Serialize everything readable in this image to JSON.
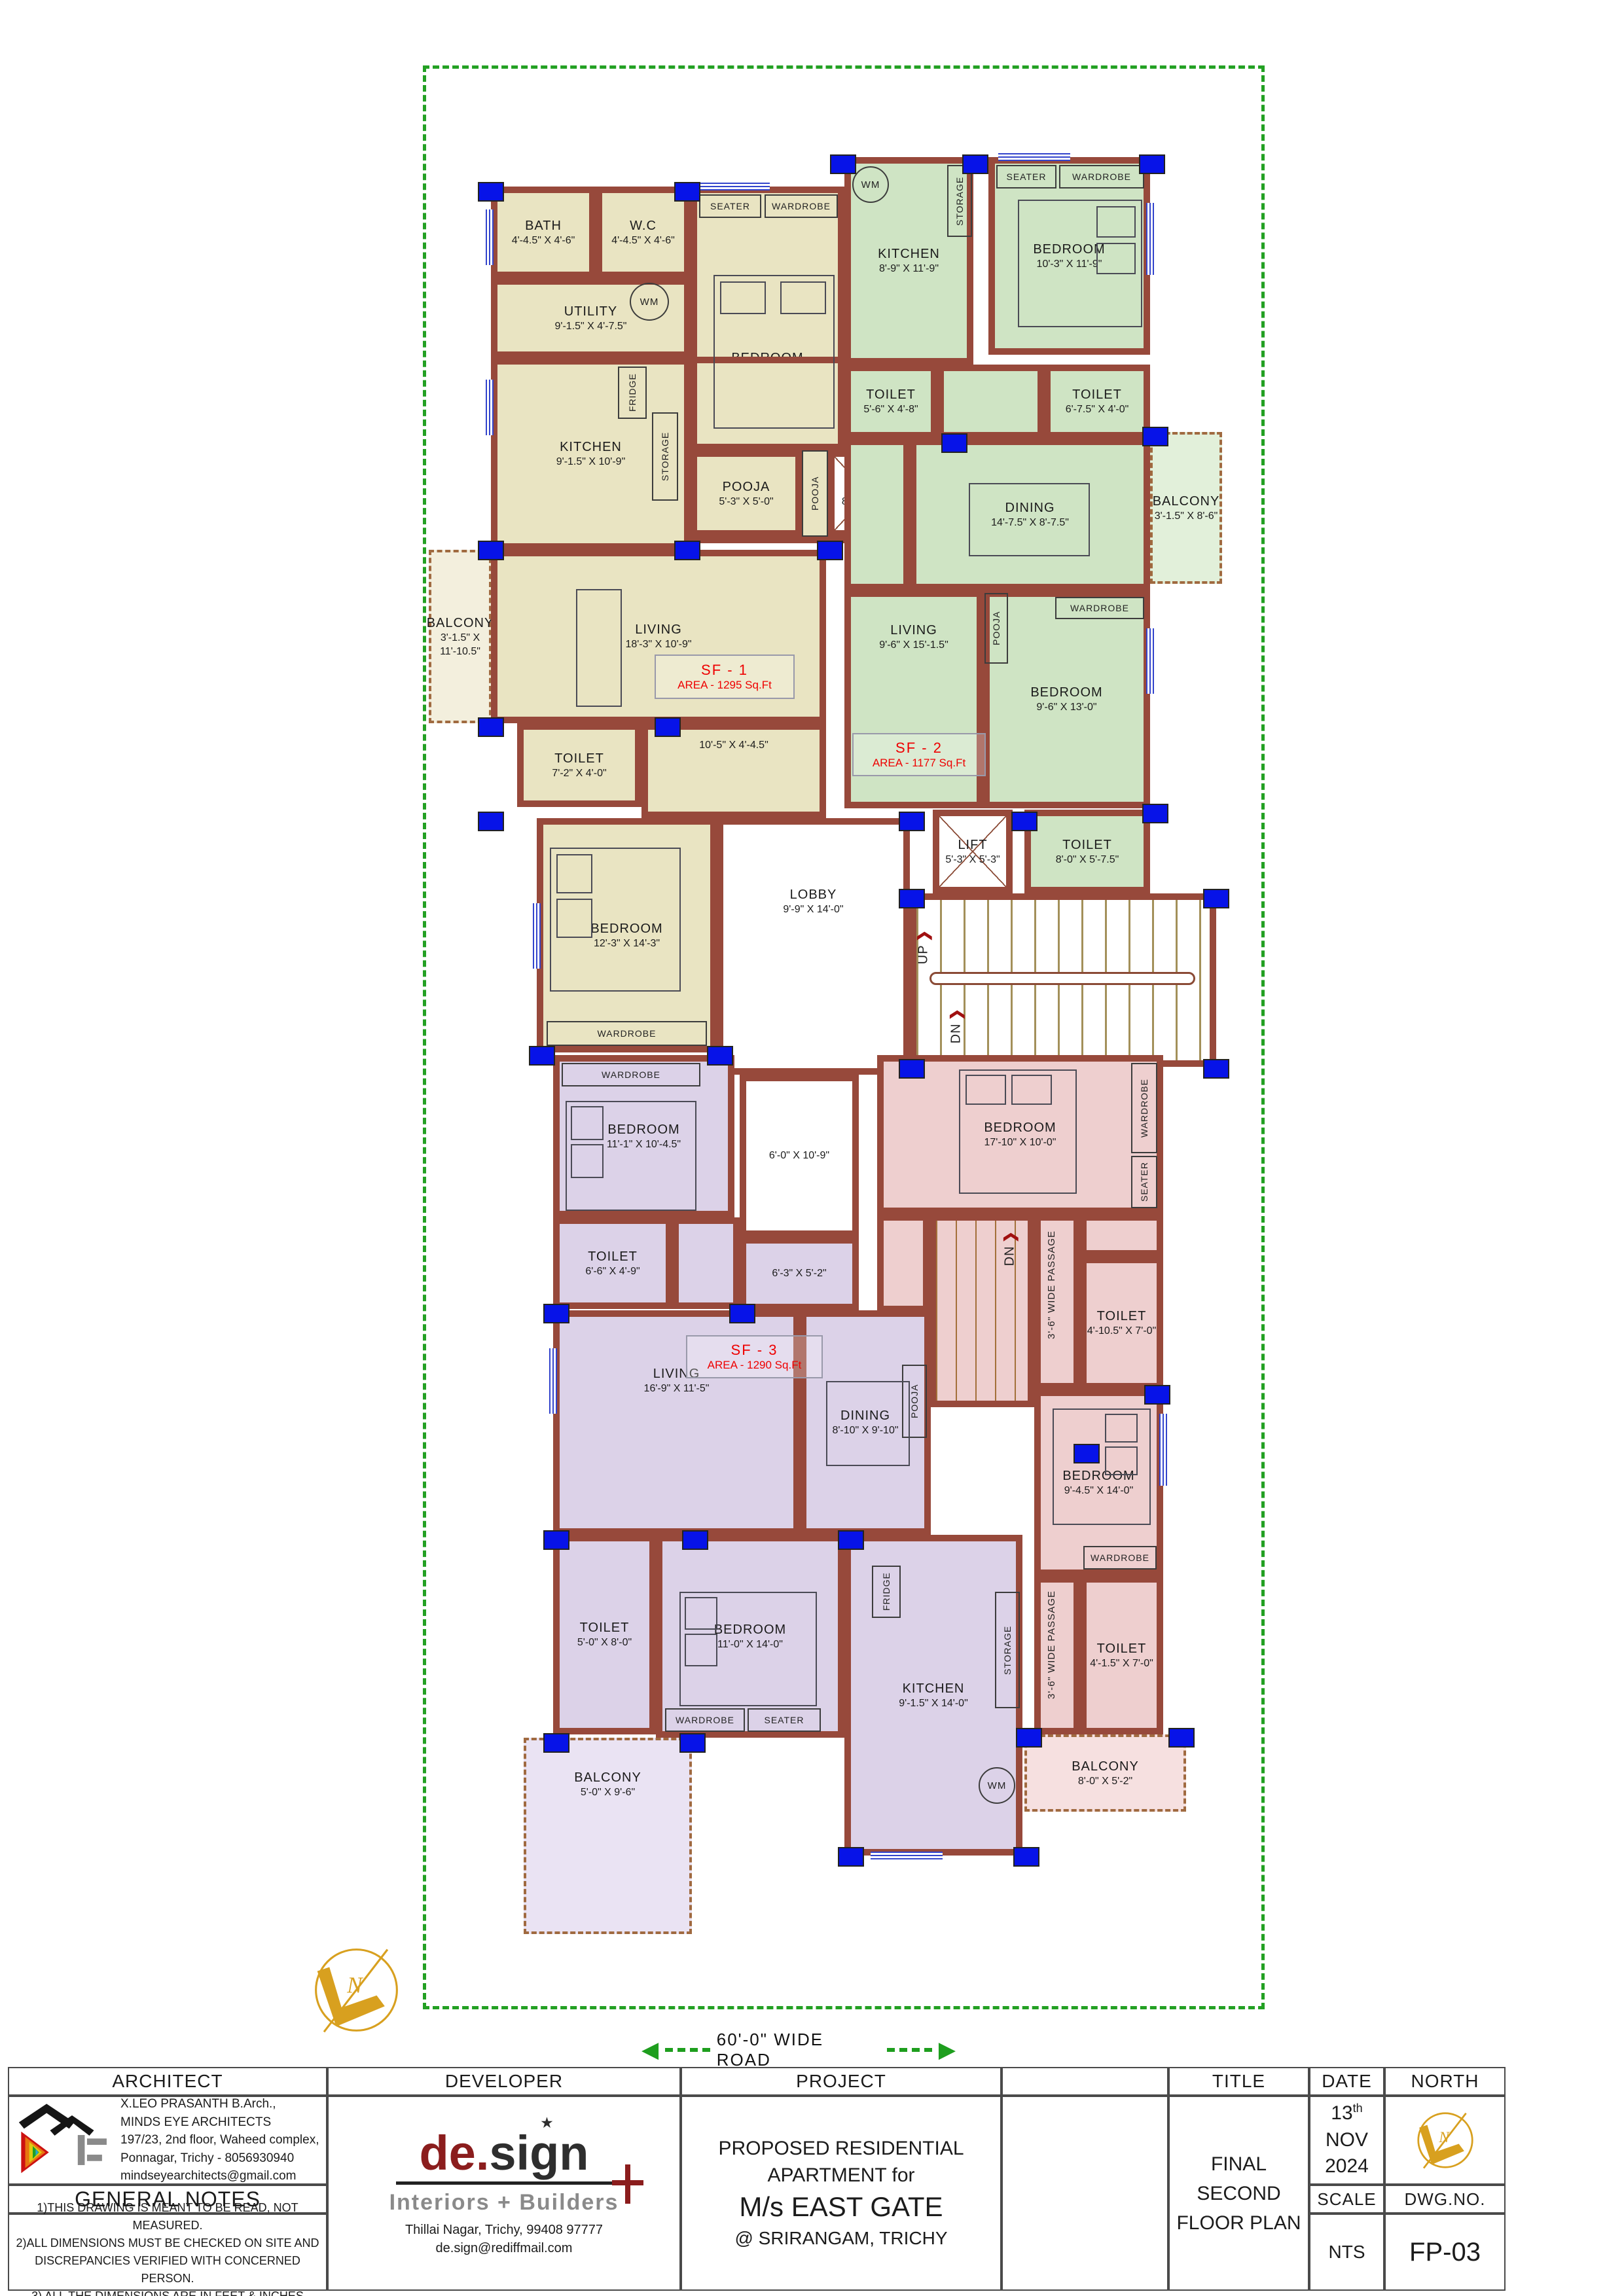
{
  "plan": {
    "units": {
      "sf1": {
        "name": "SF - 1",
        "area": "AREA  -  1295 Sq.Ft"
      },
      "sf2": {
        "name": "SF - 2",
        "area": "AREA  -  1177 Sq.Ft"
      },
      "sf3": {
        "name": "SF - 3",
        "area": "AREA  -  1290 Sq.Ft"
      }
    },
    "rooms": {
      "bath": {
        "label": "BATH",
        "dim": "4'-4.5\" X 4'-6\""
      },
      "wc": {
        "label": "W.C",
        "dim": "4'-4.5\" X 4'-6\""
      },
      "utility": {
        "label": "UTILITY",
        "dim": "9'-1.5\" X 4'-7.5\""
      },
      "bedroom1_sf1": {
        "label": "BEDROOM",
        "dim": "10'-0\" X 15'-0\""
      },
      "kitchen_sf1": {
        "label": "KITCHEN",
        "dim": "9'-1.5\" X 10'-9\""
      },
      "pooja_sf1": {
        "label": "POOJA",
        "dim": "5'-3\" X 5'-0\""
      },
      "ots": {
        "label": "O.T.S",
        "dim": "8'-9\" X 5'-0\""
      },
      "living_sf1": {
        "label": "LIVING",
        "dim": "18'-3\" X 10'-9\""
      },
      "balcony_sf1": {
        "label": "BALCONY",
        "dim": "3'-1.5\" X 11'-10.5\""
      },
      "toilet_sf1": {
        "label": "TOILET",
        "dim": "7'-2\" X 4'-0\""
      },
      "passage_sf1": {
        "dim": "10'-5\" X 4'-4.5\""
      },
      "bedroom2_sf1": {
        "label": "BEDROOM",
        "dim": "12'-3\" X 14'-3\""
      },
      "lobby": {
        "label": "LOBBY",
        "dim": "9'-9\" X 14'-0\""
      },
      "kitchen_sf2": {
        "label": "KITCHEN",
        "dim": "8'-9\" X 11'-9\""
      },
      "bedroom1_sf2": {
        "label": "BEDROOM",
        "dim": "10'-3\" X 11'-9\""
      },
      "toilet1_sf2": {
        "label": "TOILET",
        "dim": "5'-6\" X 4'-8\""
      },
      "toilet2_sf2": {
        "label": "TOILET",
        "dim": "6'-7.5\" X 4'-0\""
      },
      "dining_sf2": {
        "label": "DINING",
        "dim": "14'-7.5\" X 8'-7.5\""
      },
      "balcony_sf2": {
        "label": "BALCONY",
        "dim": "3'-1.5\" X 8'-6\""
      },
      "living_sf2": {
        "label": "LIVING",
        "dim": "9'-6\" X 15'-1.5\""
      },
      "bedroom2_sf2": {
        "label": "BEDROOM",
        "dim": "9'-6\" X 13'-0\""
      },
      "toilet3_sf2": {
        "label": "TOILET",
        "dim": "8'-0\" X 5'-7.5\""
      },
      "lift": {
        "label": "LIFT",
        "dim": "5'-3\" X 5'-3\""
      },
      "open_sf3": {
        "dim": "6'-0\" X 10'-9\""
      },
      "bedroom1_sf3": {
        "label": "BEDROOM",
        "dim": "11'-1\" X 10'-4.5\""
      },
      "toilet1_sf3": {
        "label": "TOILET",
        "dim": "6'-6\" X 4'-9\""
      },
      "passage_sf3": {
        "dim": "6'-3\" X 5'-2\""
      },
      "living_sf3": {
        "label": "LIVING",
        "dim": "16'-9\" X 11'-5\""
      },
      "dining_sf3": {
        "label": "DINING",
        "dim": "8'-10\" X 9'-10\""
      },
      "toilet2_sf3": {
        "label": "TOILET",
        "dim": "5'-0\" X 8'-0\""
      },
      "bedroom2_sf3": {
        "label": "BEDROOM",
        "dim": "11'-0\" X 14'-0\""
      },
      "kitchen_sf3": {
        "label": "KITCHEN",
        "dim": "9'-1.5\" X 14'-0\""
      },
      "balcony_sf3": {
        "label": "BALCONY",
        "dim": "5'-0\" X 9'-6\""
      },
      "bedroom1_sf4": {
        "label": "BEDROOM",
        "dim": "17'-10\" X 10'-0\""
      },
      "toilet1_sf4": {
        "label": "TOILET",
        "dim": "4'-10.5\" X 7'-0\""
      },
      "bedroom2_sf4": {
        "label": "BEDROOM",
        "dim": "9'-4.5\" X 14'-0\""
      },
      "toilet2_sf4": {
        "label": "TOILET",
        "dim": "4'-1.5\" X 7'-0\""
      },
      "balcony_sf4": {
        "label": "BALCONY",
        "dim": "8'-0\" X 5'-2\""
      }
    },
    "fixtures": {
      "wardrobe": "WARDROBE",
      "seater": "SEATER",
      "storage": "STORAGE",
      "fridge": "FRIDGE",
      "pooja": "POOJA",
      "wm": "WM",
      "up": "UP",
      "dn": "DN",
      "wide_passage": "3'-6\" WIDE PASSAGE",
      "stair_arrow": "❯"
    },
    "road_label": "60'-0\"  WIDE  ROAD",
    "road_arrow_left": "◀",
    "road_arrow_right": "▶",
    "compass_letter": "N"
  },
  "titleblock": {
    "headers": {
      "architect": "ARCHITECT",
      "developer": "DEVELOPER",
      "project": "PROJECT",
      "title": "TITLE",
      "date": "DATE",
      "north": "NORTH",
      "scale": "SCALE",
      "dwg_no": "DWG.NO.",
      "general_notes": "GENERAL NOTES"
    },
    "architect": {
      "line1": "X.LEO PRASANTH  B.Arch.,",
      "line2": "MINDS EYE ARCHITECTS",
      "line3": "197/23, 2nd floor, Waheed complex,",
      "line4": "Ponnagar, Trichy   -   8056930940",
      "line5": "mindseyearchitects@gmail.com"
    },
    "general_notes": [
      "1)THIS DRAWING IS MEANT TO BE READ, NOT MEASURED.",
      "2)ALL DIMENSIONS MUST BE CHECKED ON SITE AND",
      "DISCREPANCIES VERIFIED WITH CONCERNED PERSON.",
      "3) ALL THE DIMENSIONS ARE IN FEET & INCHES"
    ],
    "developer": {
      "logo_de": "de.",
      "logo_sign": "sign",
      "logo_star": "★",
      "logo_sub": "Interiors + Builders",
      "line1": "Thillai Nagar, Trichy, 99408 97777",
      "line2": "de.sign@rediffmail.com"
    },
    "project": {
      "line1": "PROPOSED RESIDENTIAL APARTMENT for",
      "line2": "M/s  EAST GATE",
      "line3": "@ SRIRANGAM,  TRICHY"
    },
    "title_value": [
      "FINAL",
      "SECOND",
      "FLOOR PLAN"
    ],
    "date_value": {
      "day": "13",
      "suffix": "th",
      "month": "NOV",
      "year": "2024"
    },
    "scale_value": "NTS",
    "dwg_value": "FP-03"
  }
}
